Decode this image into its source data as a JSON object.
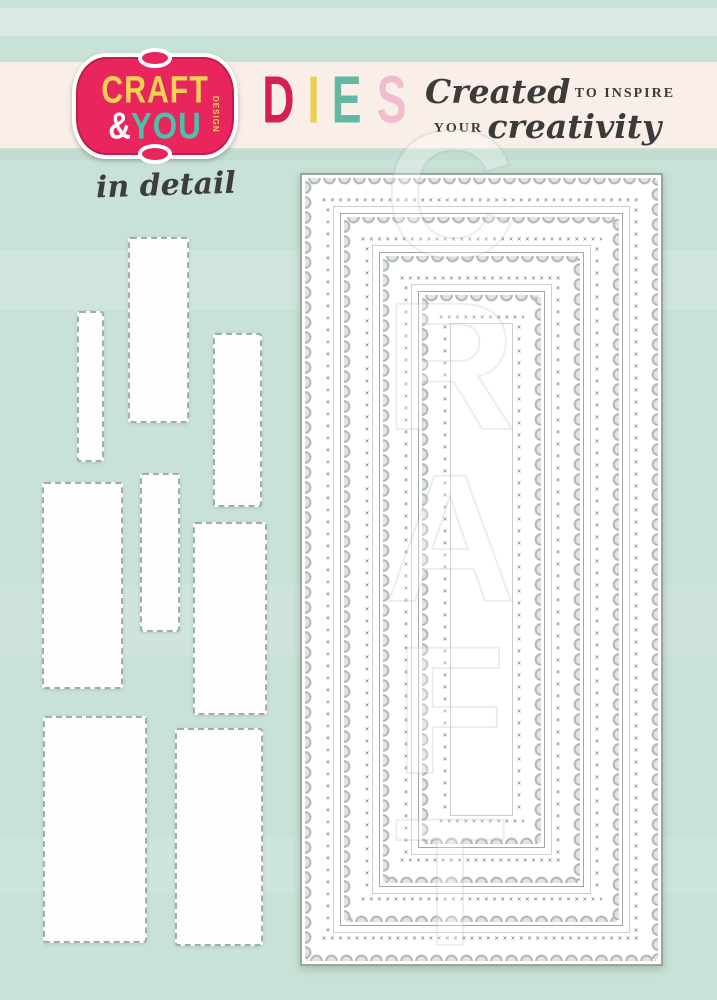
{
  "page": {
    "background_color": "#c9e2d7",
    "banner_color": "#f9efe8"
  },
  "logo": {
    "badge_color": "#e8255d",
    "line1": "CRAFT",
    "amp": "&",
    "line2": "YOU",
    "vertical_text": "DESIGN",
    "line1_color": "#f2d155",
    "line2_color": "#4cc0a9"
  },
  "product_title": {
    "text": "DIES",
    "letters": [
      {
        "char": "D",
        "color": "#d62150"
      },
      {
        "char": "I",
        "color": "#e9cf56"
      },
      {
        "char": "E",
        "color": "#62b9a3"
      },
      {
        "char": "S",
        "color": "#f2bccf"
      }
    ]
  },
  "tagline": {
    "script1": "Created",
    "caps1": "to inspire",
    "caps2": "your",
    "script2": "creativity",
    "color": "#3b3b3b"
  },
  "detail_label": {
    "text": "in detail"
  },
  "watermark": {
    "letters": [
      "C",
      "R",
      "A",
      "F",
      "T"
    ]
  },
  "die_set": {
    "nested_count": 4,
    "style": "scalloped rectangles with cross-stitch borders",
    "outline_color": "#a2a9a4",
    "stitch_color": "#6e746f"
  },
  "loose_pieces": {
    "count": 8,
    "style": "plain stitched rectangles"
  },
  "decor": {
    "stitch_glyph": "✕"
  }
}
